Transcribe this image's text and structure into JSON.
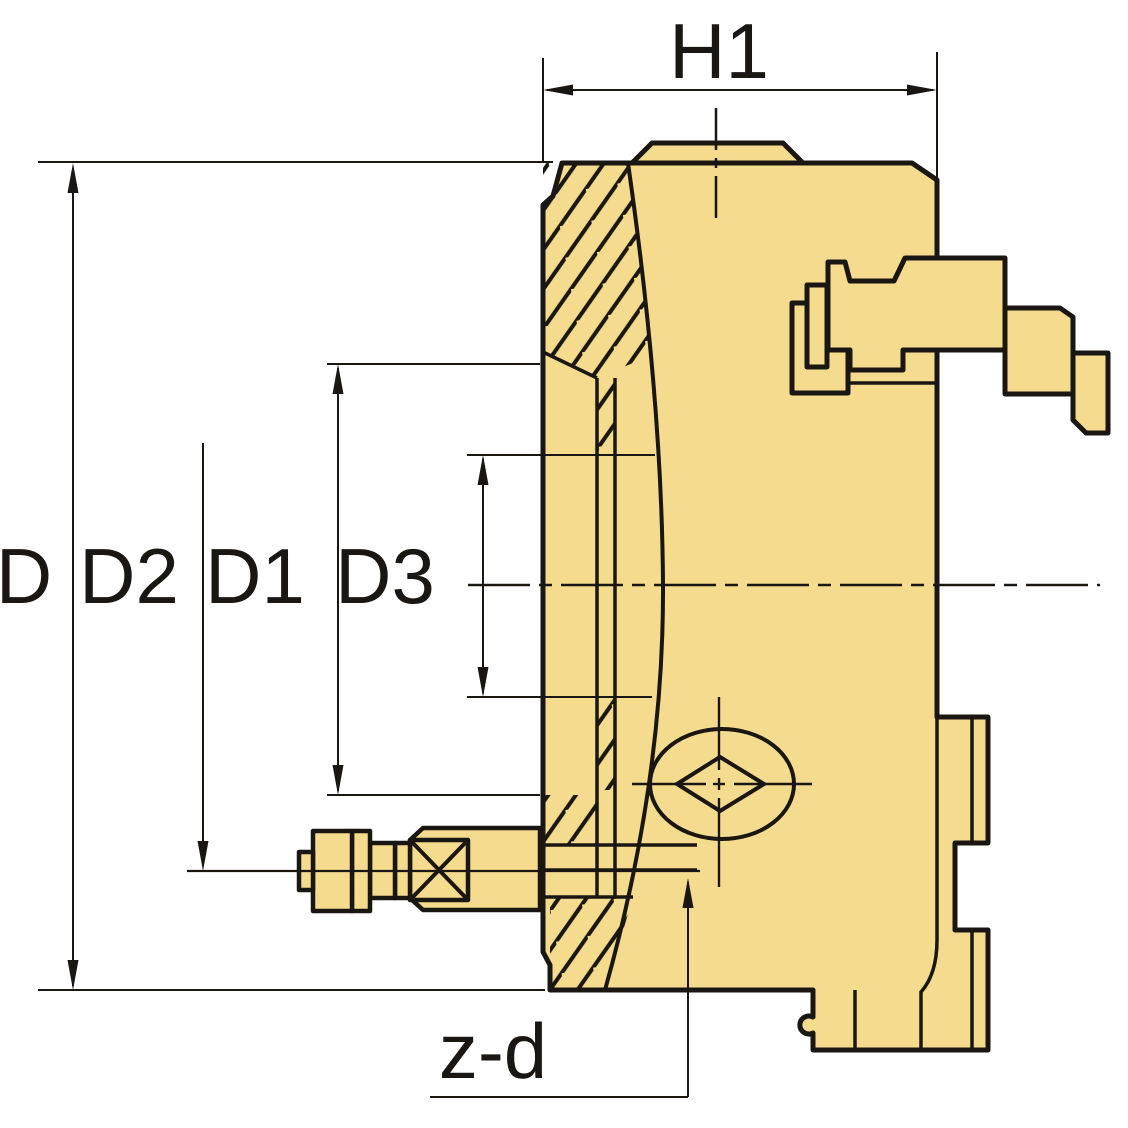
{
  "diagram": {
    "title": "Lathe chuck side cross-section with dimension callouts",
    "labels": {
      "d": "D",
      "d2": "D2",
      "d1": "D1",
      "d3": "D3",
      "h1": "H1",
      "zd": "z-d"
    },
    "colors": {
      "body_fill": "#F5DB8D",
      "line": "#1A1713",
      "background": "#FFFFFF"
    }
  }
}
